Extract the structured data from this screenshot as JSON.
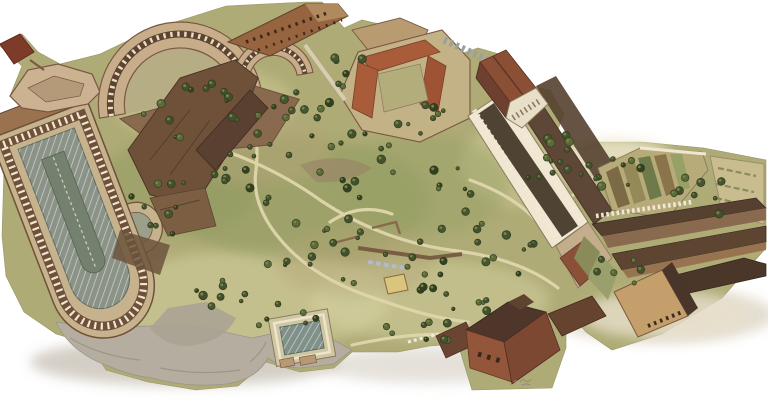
{
  "figure": {
    "type": "aerial-illustration",
    "medium": "watercolor bird's-eye reconstruction drawing on white background",
    "subject": "Bird's-eye watercolor view of a hilltop archaeological complex with ruins, sunken stadium garden, curved arcades, colonnade, tiled-roof buildings, gardens and trees"
  },
  "palette": {
    "background": "#ffffff",
    "terrain_green": "#aeab76",
    "terrain_light": "#d6d2a2",
    "terrain_dark": "#8f9a5f",
    "tree_dark": "#42502c",
    "stone_tan": "#c8ad8a",
    "brick_brown": "#8a5a3f",
    "brick_dark": "#5e4330",
    "roof_red": "#a85c3a",
    "roof_dark": "#4e372a",
    "cliff_gray": "#b5aea0",
    "pool_gray": "#8b9288",
    "path_cream": "#e0d6ac",
    "colonnade_white": "#efe7d2"
  },
  "regions": {
    "curved_arcade": {
      "label": "Curved arcade ruin",
      "description": "Double hemicycle arcade ruin with tan stone bands and dark arched openings, upper left"
    },
    "corner_bastion": {
      "label": "Corner bastion",
      "description": "Angular bastion platform jutting out at the upper-left edge with a small dark brick block"
    },
    "top_strip": {
      "label": "Top strip building",
      "description": "Narrow brick building with rows of dark windows along the top edge"
    },
    "terrace_ruins": {
      "label": "Terrace ruins",
      "description": "Massive dark-brown terrace and wall ruins on the center-left slope"
    },
    "courtyard_building": {
      "label": "Courtyard building",
      "description": "Building with red tiled roofs around a cloister courtyard, top center"
    },
    "hillside_gardens": {
      "label": "Hillside gardens",
      "description": "Green hilltop with scattered dark trees, winding cream paths and low excavated ruins"
    },
    "stadium_garden": {
      "label": "Sunken stadium garden",
      "description": "Long sunken stadium-shaped garden with arcaded walls, hatched gray floor and rounded end, left side"
    },
    "colonnade": {
      "label": "Grand colonnade",
      "description": "Long white colonnade with dark core running diagonally on the center-right"
    },
    "temple_hall": {
      "label": "Temple-fronted hall",
      "description": "Gable-roofed hall with white columned porch at the head of the colonnade"
    },
    "vineyard_plots": {
      "label": "Garden plots",
      "description": "Rows of cultivated garden plots behind a white post wall on the right"
    },
    "farm_buildings": {
      "label": "Farm buildings",
      "description": "Cluster of long buildings with dark pitched roofs and a tan barn, lower right"
    },
    "brick_church": {
      "label": "Brick church building",
      "description": "Tall brick church-like building with dark gabled roof projecting from the lower edge"
    },
    "pool_courtyard": {
      "label": "Pool courtyard",
      "description": "Sunken rectangular courtyard with a gray pool and white rim, bottom center-left"
    },
    "gray_cliffs": {
      "label": "Gray cliffs",
      "description": "Bare gray scalloped slopes and shadow along the lower-left edge"
    },
    "signature": {
      "label": "Signature mark",
      "description": "Illegible tiny pencil squiggle near the bottom center-right"
    }
  }
}
